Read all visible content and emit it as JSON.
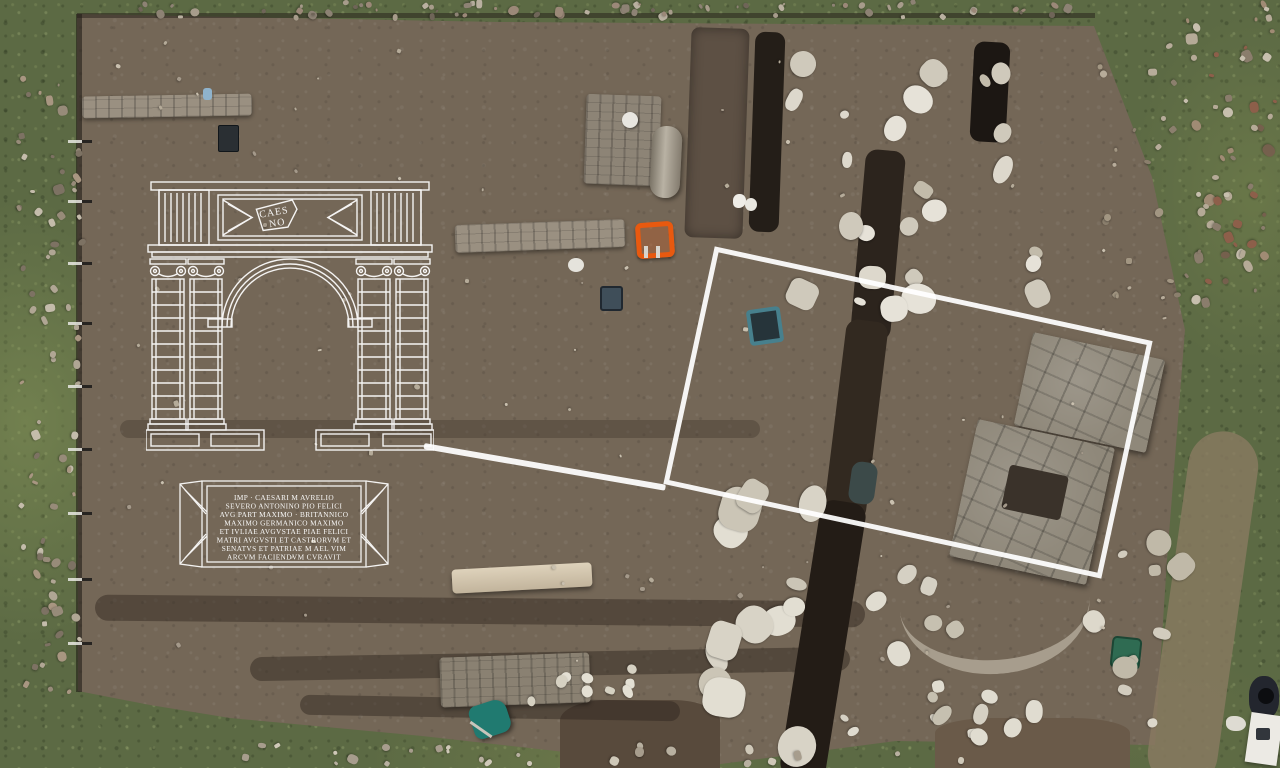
{
  "overlay": {
    "color": "#ffffff",
    "arch_fragment": {
      "line1": "CAES",
      "line2": "NO"
    },
    "inscription": {
      "lines": [
        "IMP · CAESARI M AVRELIO",
        "SEVERO ANTONINO PIO FELICI",
        "AVG PART MAXIMO · BRITANNICO",
        "MAXIMO GERMANICO MAXIMO",
        "ET IVLIAE AVGVSTAE PIAE FELICI",
        "MATRI AVGVSTI ET CASTRORVM ET",
        "SENATVS ET PATRIAE M AEL VIM",
        "ARCVM FACIENDVM CVRAVIT"
      ]
    }
  },
  "photo": {
    "accent_colors": {
      "orange_wheelbarrow": "#e8590f",
      "teal_wheelbarrow": "#1f7d72",
      "teal_sieve": "#47808d",
      "green_bucket": "#2f6b52",
      "grass": "#5c6a44",
      "earth": "#746757",
      "marble": "#d9d4c9"
    }
  }
}
